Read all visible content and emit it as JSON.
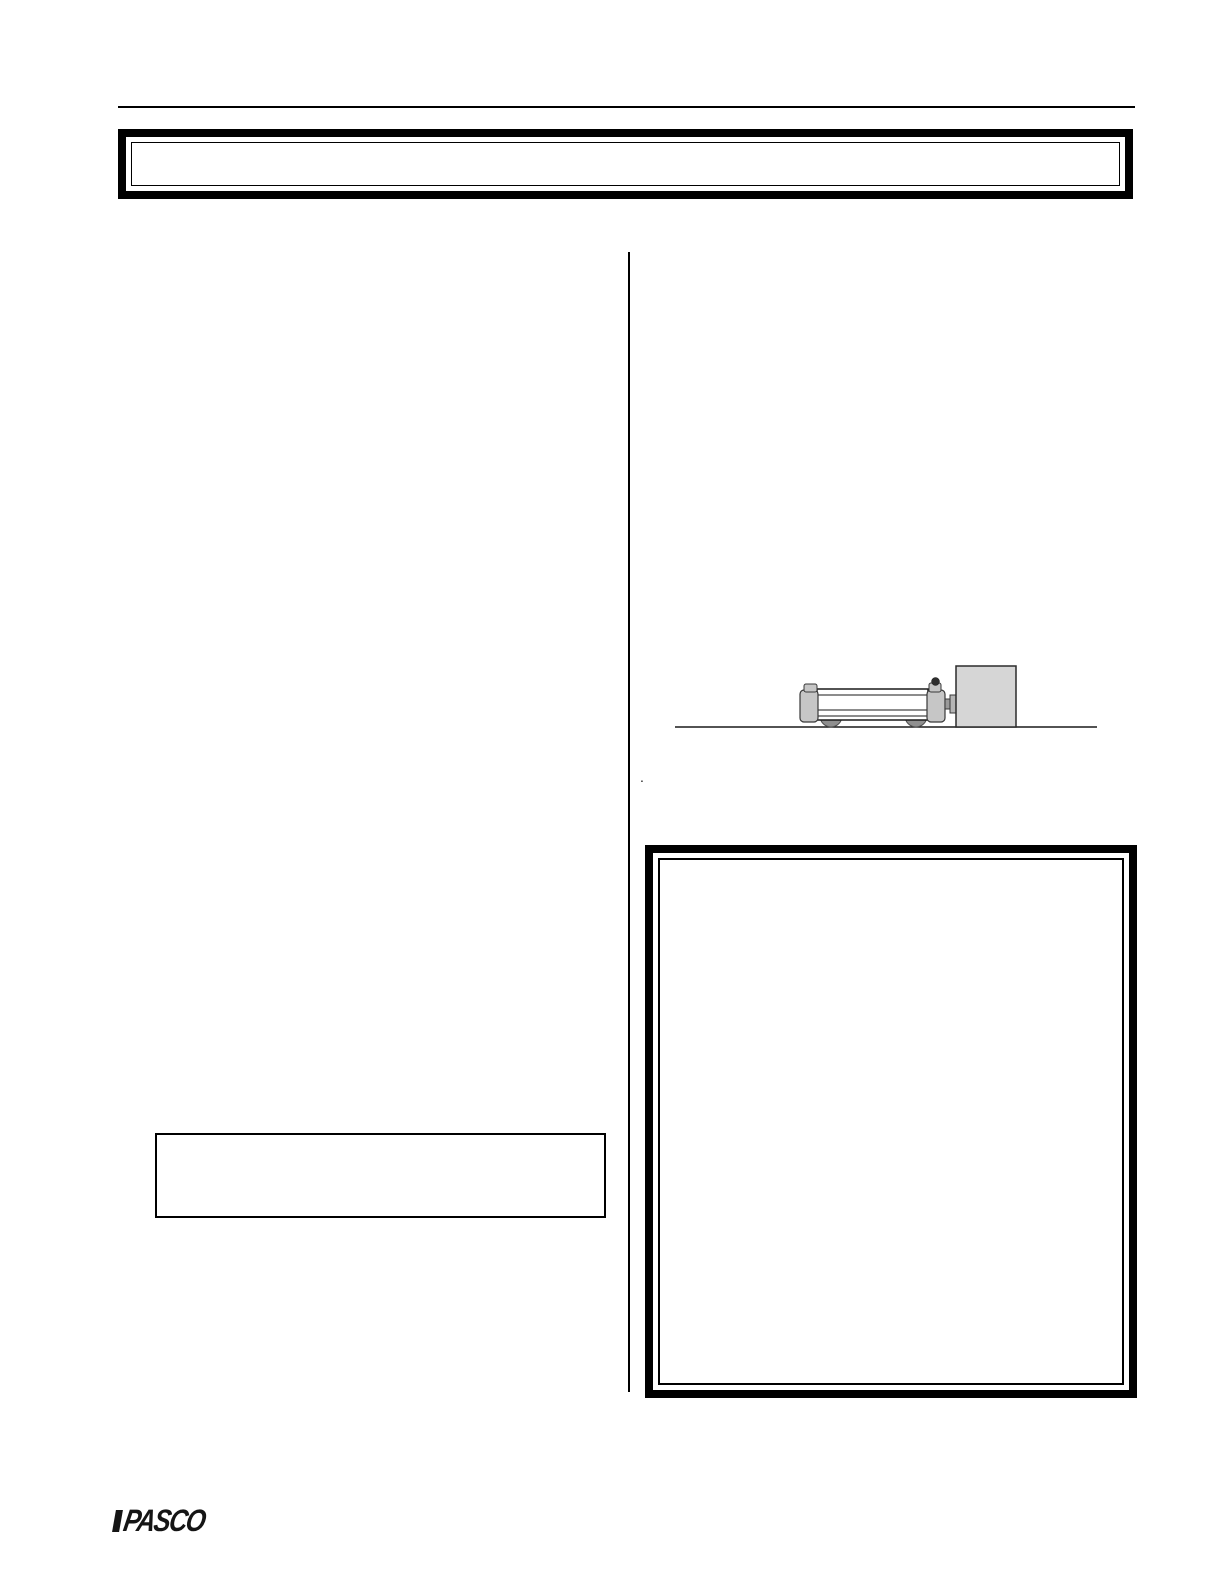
{
  "banner": {
    "text": ""
  },
  "figure": {
    "description": "dynamics cart with plunger compressed against a block on a level surface",
    "elements": {
      "ground": "ground-line",
      "cart": "dynamics-cart",
      "wheels": "cart-wheels",
      "plunger": "plunger-rod",
      "block": "block"
    }
  },
  "stray_mark": ".",
  "footer": {
    "logo_text": "PASCO"
  },
  "colors": {
    "ink": "#000000",
    "cap_fill": "#c6c6c6",
    "wheel_fill": "#8f8f8f",
    "block_fill": "#d6d6d6",
    "knob_fill": "#2f2f2f"
  }
}
